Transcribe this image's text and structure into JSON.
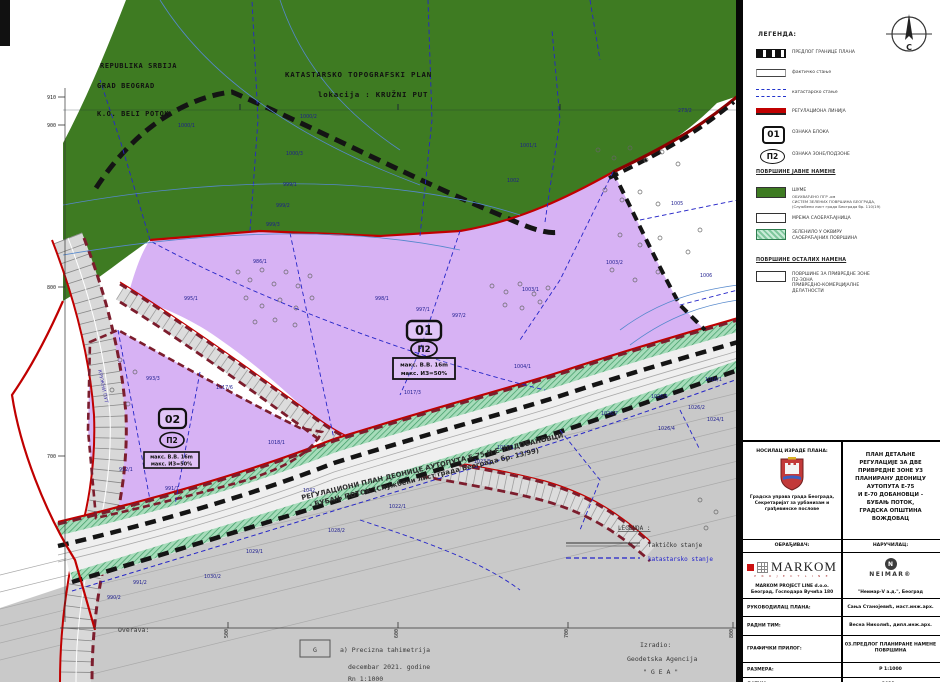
{
  "map": {
    "corner_header": {
      "line1": "REPUBLIKA SRBIJA",
      "line2": "GRAD BEOGRAD",
      "line3": "K.O. BELI POTOK"
    },
    "plan_header": {
      "line1": "KATASTARSKO TOPOGRAFSKI PLAN",
      "line2": "lokacija : KRUŽNI PUT"
    },
    "zone1": {
      "block": "01",
      "zone": "П2",
      "max1": "макс. В.В. 16m",
      "max2": "макс. ИЗ=50%"
    },
    "zone2": {
      "block": "02",
      "zone": "П2",
      "max1": "макс. В.В. 16m",
      "max2": "макс. ИЗ=50%"
    },
    "diag_note_line1": "РЕГУЛАЦИОНИ ПЛАН ДЕОНИЦЕ АУТОПУТА Е-75 И Е-70 ДОБАНОВЦИ",
    "diag_note_line2": "- БУБАЊ ПОТОК (Службени лист града Београда бр. 13/99)",
    "road_label": "КРУЖНИ ПУТ",
    "mini_legend": {
      "title": "LEGENDA :",
      "item1": "faktičko stanje",
      "item2": "katastarsko stanje"
    },
    "footer": {
      "overava": "Overava:",
      "stamp": "G",
      "note1": "a) Precizna tahimetrija",
      "note2": "decembar 2021. godine",
      "note3": "Rn 1:1000",
      "izradio": "Izradio:",
      "agency1": "Geodetska Agencija",
      "agency2": "\" G E A \""
    },
    "grid": {
      "left": [
        {
          "t": "910",
          "y": 97
        },
        {
          "t": "900",
          "y": 125
        },
        {
          "t": "800",
          "y": 287
        },
        {
          "t": "700",
          "y": 456
        }
      ],
      "bottom": [
        {
          "t": "500",
          "x": 228
        },
        {
          "t": "600",
          "x": 398
        },
        {
          "t": "700",
          "x": 568
        },
        {
          "t": "800",
          "x": 733
        }
      ]
    },
    "parcels": [
      {
        "n": "1000/1",
        "x": 178,
        "y": 127
      },
      {
        "n": "1000/2",
        "x": 300,
        "y": 118
      },
      {
        "n": "1000/3",
        "x": 286,
        "y": 155
      },
      {
        "n": "999/1",
        "x": 283,
        "y": 186
      },
      {
        "n": "999/2",
        "x": 276,
        "y": 207
      },
      {
        "n": "999/3",
        "x": 266,
        "y": 226
      },
      {
        "n": "1001/1",
        "x": 520,
        "y": 147
      },
      {
        "n": "1002",
        "x": 507,
        "y": 182
      },
      {
        "n": "273/2",
        "x": 678,
        "y": 112
      },
      {
        "n": "1005",
        "x": 671,
        "y": 205
      },
      {
        "n": "1006",
        "x": 700,
        "y": 277
      },
      {
        "n": "986/1",
        "x": 253,
        "y": 263
      },
      {
        "n": "995/1",
        "x": 184,
        "y": 300
      },
      {
        "n": "998/1",
        "x": 375,
        "y": 300
      },
      {
        "n": "997/1",
        "x": 416,
        "y": 311
      },
      {
        "n": "997/2",
        "x": 452,
        "y": 317
      },
      {
        "n": "1003/2",
        "x": 606,
        "y": 264
      },
      {
        "n": "1003/1",
        "x": 522,
        "y": 291
      },
      {
        "n": "1004/1",
        "x": 514,
        "y": 368
      },
      {
        "n": "1017/6",
        "x": 216,
        "y": 389
      },
      {
        "n": "1017/3",
        "x": 404,
        "y": 394
      },
      {
        "n": "1016/1",
        "x": 705,
        "y": 381
      },
      {
        "n": "1026/2",
        "x": 688,
        "y": 409
      },
      {
        "n": "1024/1",
        "x": 707,
        "y": 421
      },
      {
        "n": "1026/5",
        "x": 651,
        "y": 398
      },
      {
        "n": "1026/7",
        "x": 601,
        "y": 415
      },
      {
        "n": "1026/4",
        "x": 658,
        "y": 430
      },
      {
        "n": "993/3",
        "x": 146,
        "y": 380
      },
      {
        "n": "992/1",
        "x": 119,
        "y": 471
      },
      {
        "n": "991/1",
        "x": 165,
        "y": 490
      },
      {
        "n": "1018/1",
        "x": 268,
        "y": 444
      },
      {
        "n": "1042",
        "x": 303,
        "y": 492
      },
      {
        "n": "1017/1",
        "x": 497,
        "y": 449
      },
      {
        "n": "1023/5",
        "x": 474,
        "y": 463
      },
      {
        "n": "1022/1",
        "x": 389,
        "y": 508
      },
      {
        "n": "1029/1",
        "x": 246,
        "y": 553
      },
      {
        "n": "1030/2",
        "x": 204,
        "y": 578
      },
      {
        "n": "1028/2",
        "x": 328,
        "y": 532
      },
      {
        "n": "991/2",
        "x": 133,
        "y": 584
      },
      {
        "n": "990/2",
        "x": 107,
        "y": 599
      }
    ]
  },
  "legend": {
    "title": "ЛЕГЕНДА:",
    "compass_letter": "С",
    "section1": "ПОВРШИНЕ ЈАВНЕ НАМЕНЕ",
    "section2": "ПОВРШИНЕ ОСТАЛИХ НАМЕНА",
    "items": [
      {
        "label": "ПРЕДЛОГ ГРАНИЦЕ ПЛАНА",
        "swatch": "plan-boundary"
      },
      {
        "label": "фактичко стање",
        "swatch": "factual-state"
      },
      {
        "label": "катастарско стање",
        "swatch": "cadastral-state"
      },
      {
        "label": "РЕГУЛАЦИОНА ЛИНИЈА",
        "swatch": "regulation-line"
      },
      {
        "label": "ОЗНАКА БЛОКА",
        "swatch": "block-badge",
        "badge": "01"
      },
      {
        "label": "ОЗНАКА ЗОНЕ/ПОДЗОНЕ",
        "swatch": "zone-badge",
        "badge": "П2"
      },
      {
        "label": "ШУМЕ",
        "swatch": "forest",
        "sub": "ОБУХВАЋЕНО ПГР -ом\nСИСТЕМ ЗЕЛЕНИХ ПОВРШИНА БЕОГРАДА,\n(Службени лист града Београда бр. 110/19)"
      },
      {
        "label": "МРЕЖА САОБРАЋАЈНИЦА",
        "swatch": "road-network"
      },
      {
        "label": "ЗЕЛЕНИЛО У ОКВИРУ\nСАОБРАЋАЈНИХ ПОВРШИНА",
        "swatch": "green-hatch"
      },
      {
        "label": "ПОВРШИНЕ ЗА ПРИВРЕДНЕ ЗОНЕ\nП2-ЗОНА\nПРИВРЕДНО-КОМЕРЦИЈАЛНЕ\nДЕЛАТНОСТИ",
        "swatch": "p2-zone"
      }
    ]
  },
  "titleblock": {
    "holder_header": "НОСИЛАЦ ИЗРАДЕ ПЛАНА:",
    "holder_name": "Градска управа града Београда,\nСекретаријат за урбанизам и\nграђевинске послове",
    "plan_title": "ПЛАН ДЕТАЉНЕ РЕГУЛАЦИЈЕ ЗА ДВЕ\nПРИВРЕДНЕ ЗОНЕ УЗ\nПЛАНИРАНУ ДЕОНИЦУ АУТОПУТА Е-75\nИ Е-70 ДОБАНОВЦИ - БУБАЊ ПОТОК,\nГРАДСКА ОПШТИНА ВОЖДОВАЦ",
    "obradjivac_header": "ОБРАЂИВАЧ:",
    "narucilac_header": "НАРУЧИЛАЦ:",
    "markom_name": "MARKOM",
    "markom_sub": "P R O J E C T   L I N E",
    "markom_addr": "MARKOM PROJECT LINE d.o.o.\nБеоград, Господара Вучића 180",
    "neimar_name": "NEIMAR®",
    "neimar_letter": "N",
    "neimar_addr": "\"Неимар-V а.д.\", Београд",
    "rows": [
      {
        "label": "РУКОВОДИЛАЦ ПЛАНА:",
        "value": "Сања Станојевић, маст.инж.арх."
      },
      {
        "label": "РАДНИ ТИМ:",
        "value": "Весна Николић, дипл.инж.арх."
      },
      {
        "label": "ГРАФИЧКИ ПРИЛОГ:",
        "value": "03.ПРЕДЛОГ ПЛАНИРАНЕ НАМЕНЕ\nПОВРШИНА"
      },
      {
        "label": "РАЗМЕРА:",
        "value": "Р 1:1000"
      },
      {
        "label": "ДАТУМ:",
        "value": "април 2023. године"
      }
    ]
  }
}
